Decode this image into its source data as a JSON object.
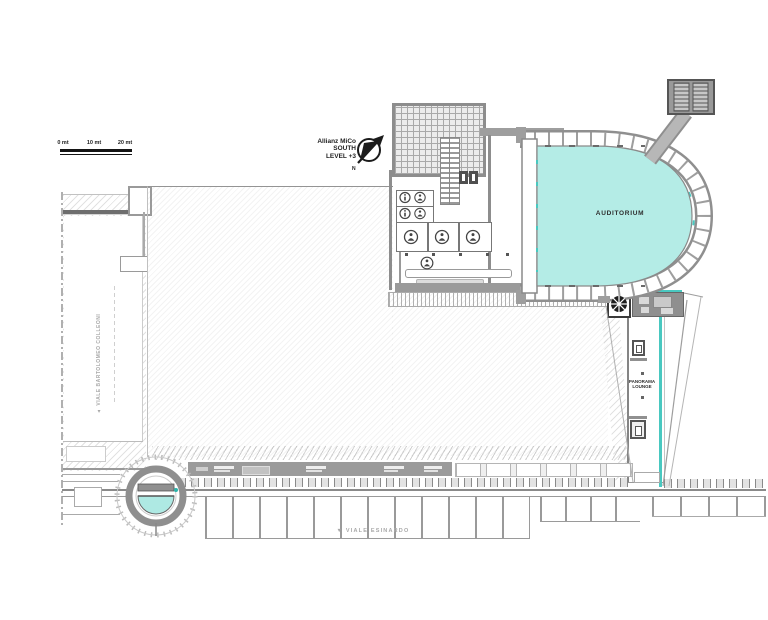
{
  "header": {
    "title_line1": "Allianz MiCo",
    "title_line2": "SOUTH",
    "title_line3": "LEVEL +3"
  },
  "scale_bar": {
    "tick0": "0 mt",
    "tick1": "10 mt",
    "tick2": "20 mt"
  },
  "labels": {
    "auditorium": "AUDITORIUM",
    "panorama_line1": "PANORAMA",
    "panorama_line2": "LOUNGE"
  },
  "streets": {
    "west": "▲ VIALE BARTOLOMEO COLLEONI",
    "south": "▼ VIALE ESINARDO"
  },
  "icons": {
    "north_arrow": "circled diagonal north arrow",
    "wc_person": "person pictogram in circle",
    "info": "letter-i pictogram in circle",
    "spiral_stair": "dark disc with radial spokes",
    "elevator": "nested squares"
  },
  "colors": {
    "auditorium_fill": "#b4ece6",
    "teal_accent": "#49c8c0",
    "wall_gray": "#9e9e9e",
    "dark_wall": "#6e6e6e",
    "street_text": "#a9a9a9"
  }
}
